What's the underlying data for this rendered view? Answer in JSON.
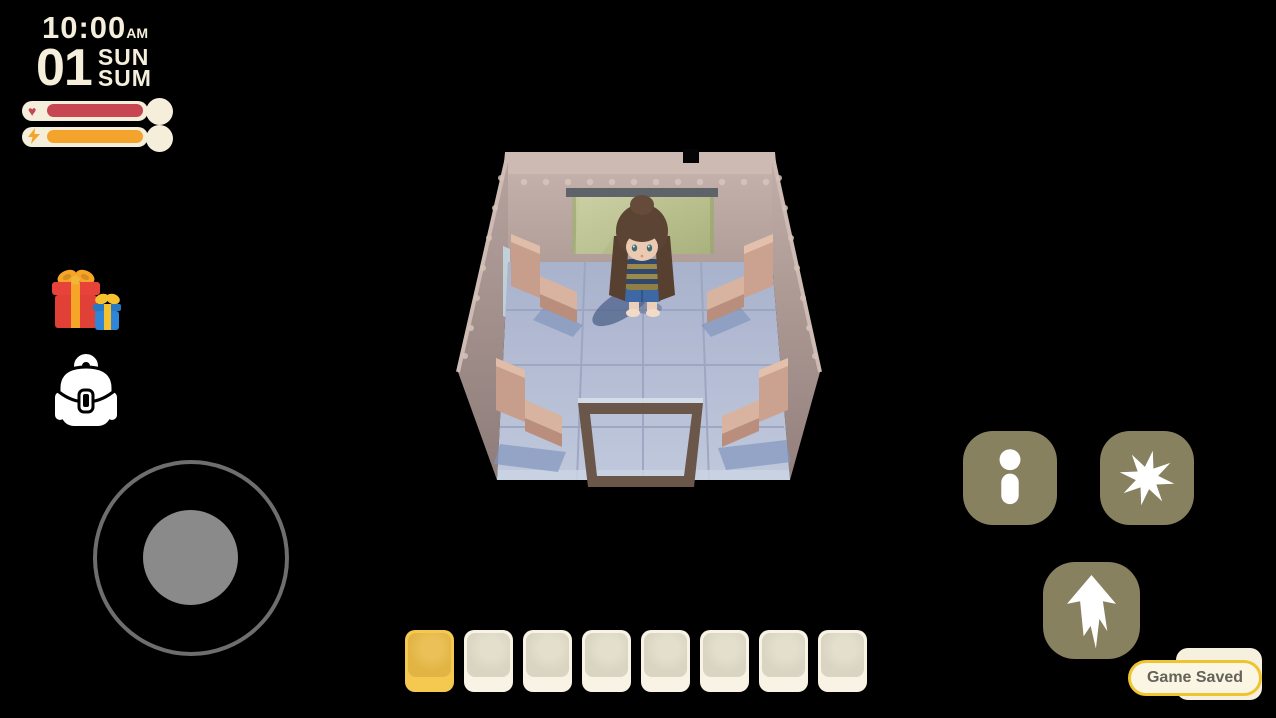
{
  "hud": {
    "clock": {
      "time": "10:00",
      "meridiem": "AM",
      "day": "01",
      "weekday": "SUN",
      "season": "SUM"
    },
    "bars": [
      {
        "name": "health",
        "icon": "heart-icon",
        "glyph": "♥",
        "fill_color": "#C84552",
        "fill_pct": 100
      },
      {
        "name": "energy",
        "icon": "bolt-icon",
        "fill_color": "#F4A42C",
        "fill_pct": 100
      }
    ],
    "panel_color": "#F5EEDA"
  },
  "side_buttons": [
    {
      "icon": "gift-icon"
    },
    {
      "icon": "backpack-icon"
    }
  ],
  "joystick": {
    "ring_color": "#6E6E6E",
    "knob_color": "#8A8A8A"
  },
  "action_buttons": {
    "bg_color": "#87815F",
    "icon_color": "#FFFFFF",
    "items": [
      {
        "icon": "info-icon"
      },
      {
        "icon": "burst-icon"
      },
      {
        "icon": "jump-arrow-icon"
      }
    ]
  },
  "hotbar": {
    "slot_count": 8,
    "selected_index": 0,
    "slot_color": "#F8F3E4",
    "slot_inner_color": "#DAD5C3",
    "selected_color": "#F5C94F",
    "selected_inner_color": "#E1B443"
  },
  "toast": {
    "text": "Game Saved",
    "border_color": "#EFC52F",
    "bg_color": "#FBF5E3",
    "text_color": "#63635A"
  },
  "scene": {
    "description": "isometric train-car style room with girl character standing inside",
    "wall_color": "#BFAAA4",
    "floor_color": "#B4BCD4",
    "window_color": "#B8BF8D",
    "bench_color": "#D8B39F",
    "door_frame_color": "#6B564A"
  }
}
